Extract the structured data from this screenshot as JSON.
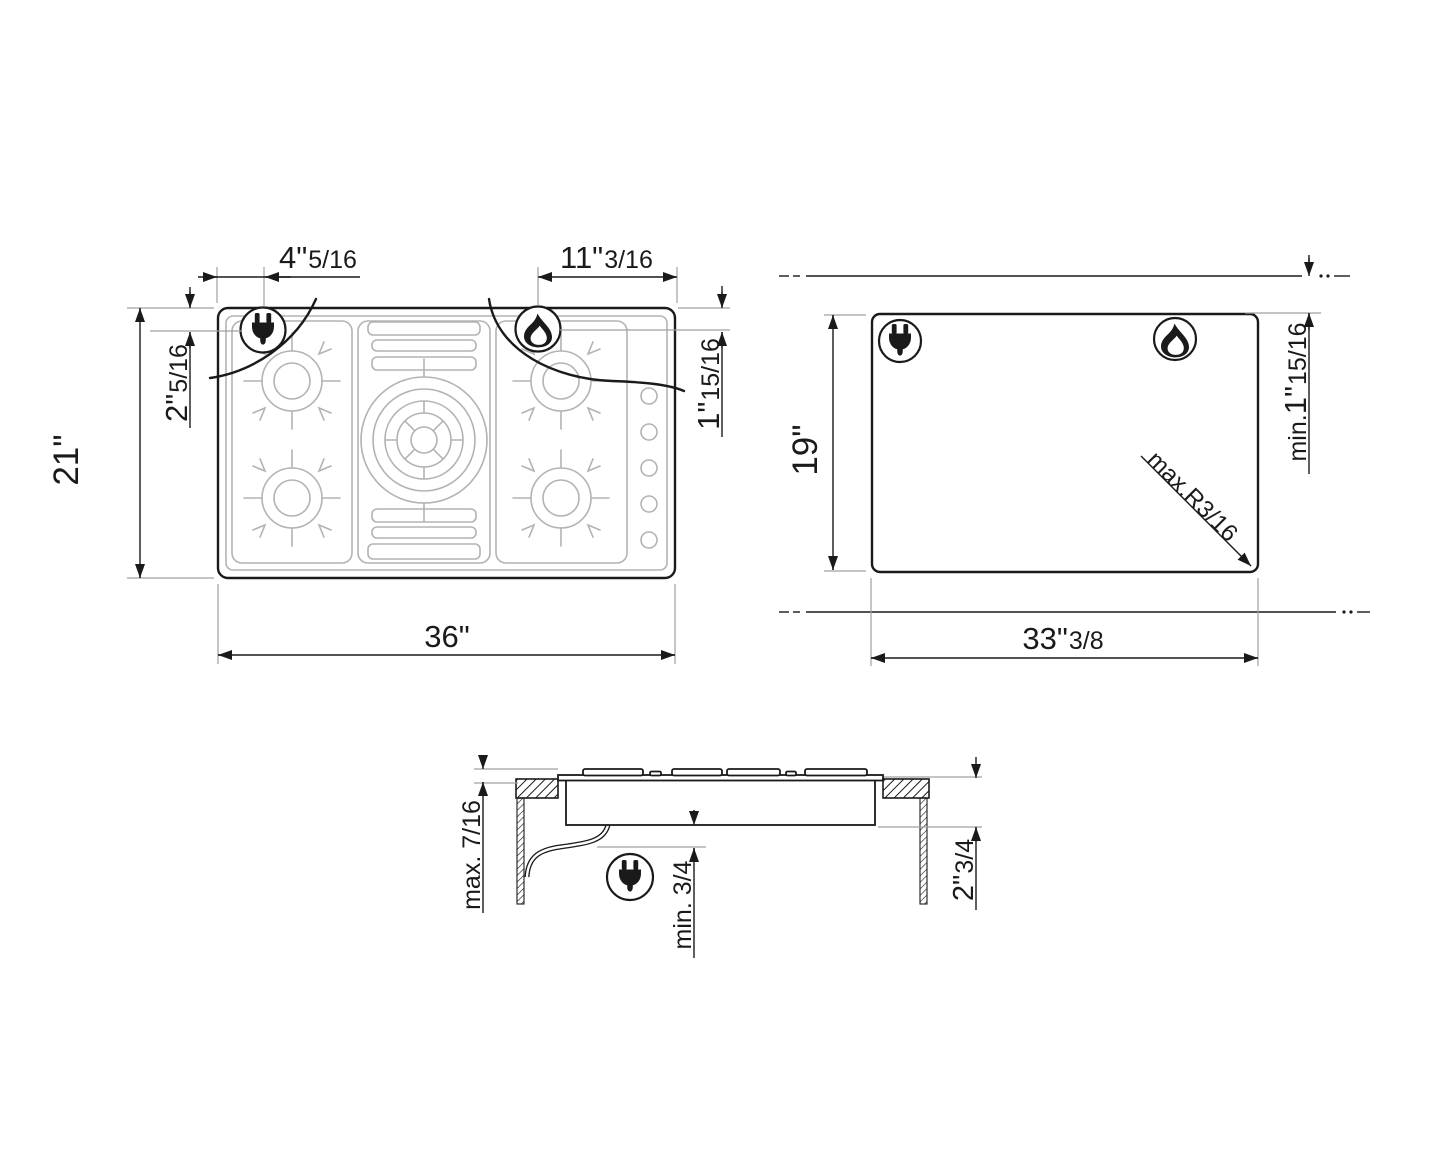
{
  "labels": {
    "plan": {
      "total_width": "36\"",
      "total_height": "21\"",
      "plug_offset_x_main": "4\"",
      "plug_offset_x_frac": "5/16",
      "plug_offset_y_main": "2\"",
      "plug_offset_y_frac": "5/16",
      "flame_offset_x_main": "11\"",
      "flame_offset_x_frac": "3/16",
      "flame_offset_y_main": "1\"",
      "flame_offset_y_frac": "15/16"
    },
    "cutout": {
      "height": "19\"",
      "width_main": "33\"",
      "width_frac": "3/8",
      "top_clearance_prefix": "min.",
      "top_clearance_main": "1\"",
      "top_clearance_frac": "15/16",
      "corner_radius": "max.R3/16"
    },
    "side": {
      "above_counter": "max. 7/16",
      "below_clearance": "min. 3/4",
      "depth_main": "2\"",
      "depth_frac": "3/4"
    }
  },
  "colors": {
    "line": "#1a1a1a",
    "detail_gray": "#b3b3b3",
    "extension_gray": "#a0a0a0",
    "background": "#ffffff"
  }
}
